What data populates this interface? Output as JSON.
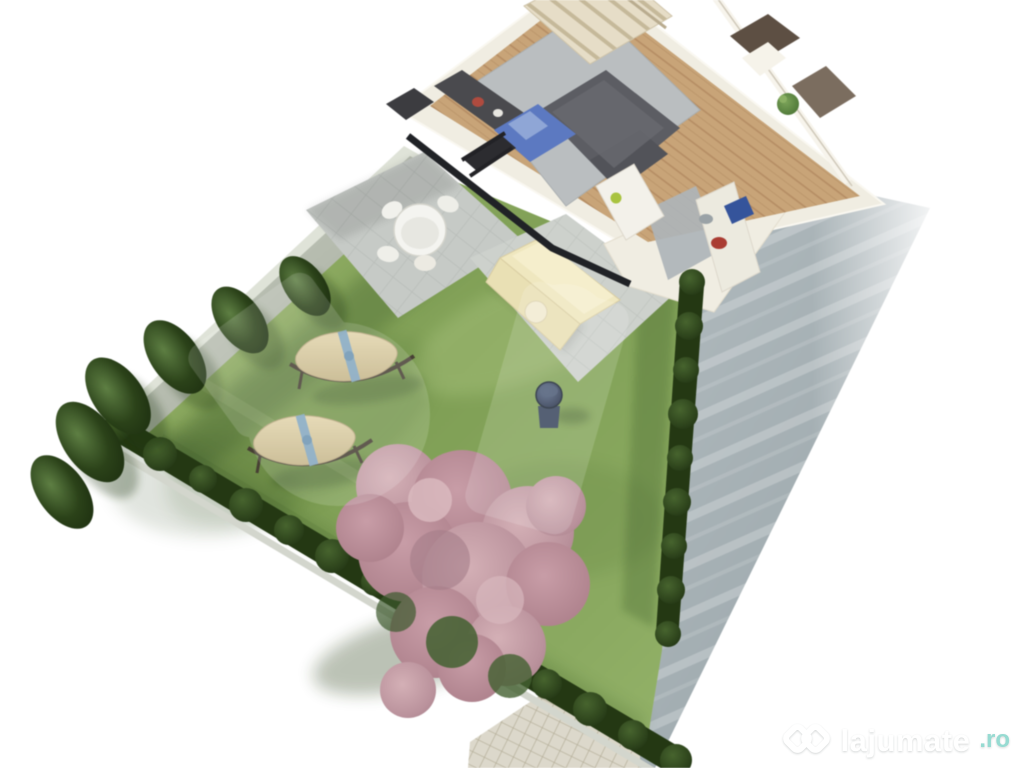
{
  "page": {
    "background": "#ffffff",
    "kind": "real-estate 3D isometric rendering of a ground-floor unit with private landscaped garden"
  },
  "watermark": {
    "brand": "lajumate",
    "tld": ".ro"
  },
  "scene": {
    "interior_elements": [
      "living-room-carpet",
      "sectional-sofa",
      "blue-daybed",
      "tv-console",
      "lounge-chair",
      "staircase",
      "kitchen-island",
      "kitchen-counter",
      "dining-apple",
      "entry-plant",
      "bathroom-doorways",
      "wood-floor",
      "glass-wall"
    ],
    "exterior_elements": [
      "concrete-privacy-wall",
      "terrace-round-table",
      "terrace-chairs",
      "patio-pallet-sofa",
      "lawn",
      "hammock-one",
      "hammock-two",
      "kettle-grill",
      "hedge-right-row",
      "hedge-bottom-row",
      "conifer-row-left",
      "pink-blossom-tree",
      "paved-driveway",
      "cobblestone-walk"
    ],
    "colors": {
      "grass": "#84a458",
      "hedge": "#2e4520",
      "blossom": "#c49da6",
      "concrete_wall": "#b5bbae",
      "house_walls": "#f0ede2",
      "wood_floor": "#c9a476",
      "sofa_gray": "#5c5d63",
      "accent_blue": "#5b79c4",
      "driveway": "#a9b3b7",
      "watermark_teal": "#8fd8cf"
    }
  }
}
